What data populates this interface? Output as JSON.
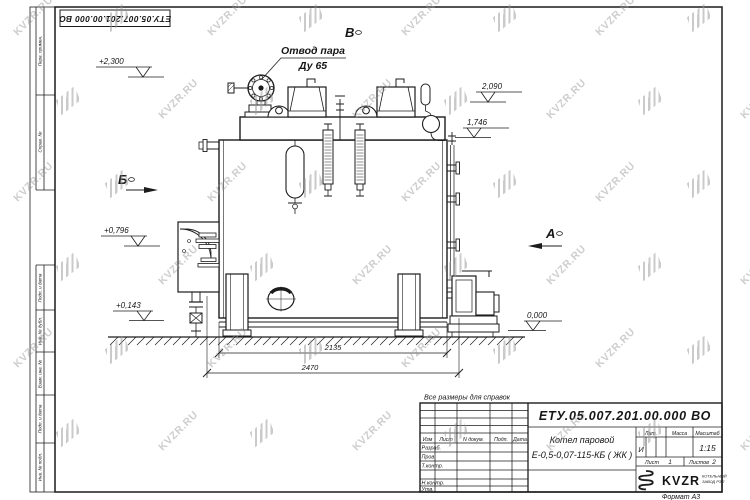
{
  "sheet": {
    "watermark_text": "KVZR.RU",
    "top_stamp": "ЕТУ.05.007.201.00.000 ВО",
    "note": "Все размеры для справок",
    "format_label": "Формат А3",
    "line_color": "#1c1c1c",
    "watermark_color": "#969696"
  },
  "margin_fields": {
    "perv_primen": "Перв. примен.",
    "sprav_no": "Справ. №",
    "podp_data1": "Подп. и дата",
    "inv_dubl": "Инв. № дубл.",
    "vzam_inv": "Взам. инв. №",
    "podp_data2": "Подп. и дата",
    "inv_podl": "Инв. № подл."
  },
  "title_block": {
    "doc_number": "ЕТУ.05.007.201.00.000  ВО",
    "product_line1": "Котел паровой",
    "product_line2": "Е-0,5-0,07-115-КБ ( ЖК )",
    "col_izm": "Изм",
    "col_list": "Лист",
    "col_ndokum": "N докум.",
    "col_podp": "Подп.",
    "col_data": "Дата",
    "row_razrab": "Разраб.",
    "row_prov": "Пров.",
    "row_tkontr": "Т.контр.",
    "row_nkontr": "Н.контр.",
    "row_utv": "Утв.",
    "lit_label": "Лит.",
    "lit_value": "И",
    "massa_label": "Масса",
    "masshtab_label": "Масштаб",
    "masshtab_value": "1:15",
    "list_label": "Лист",
    "list_value": "1",
    "listov_label": "Листов",
    "listov_value": "2",
    "brand": "KVZR",
    "brand_sub1": "КОТЕЛЬНЫЙ",
    "brand_sub2": "ЗАВОД РЭП"
  },
  "drawing": {
    "callout_line1": "Отвод пара",
    "callout_line2": "Ду 65",
    "view_v": "В",
    "view_b": "Б",
    "view_a": "А",
    "elev_plus2300": "+2,300",
    "elev_2090": "2,090",
    "elev_1746": "1,746",
    "elev_plus0796": "+0,796",
    "elev_plus0143": "+0,143",
    "elev_0000": "0,000",
    "dim_2135": "2135",
    "dim_2470": "2470"
  }
}
